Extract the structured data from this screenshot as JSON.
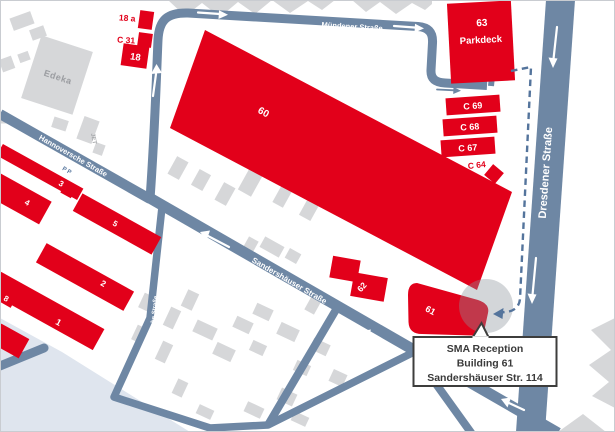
{
  "title": "SMA site map",
  "streets": {
    "muendener": "Mündener Straße",
    "dresdener": "Dresdener Straße",
    "hannoversche": "Hannoversche Straße",
    "sandershaeuser": "Sandershäuser Straße",
    "hallesche": "Hallesche Straße"
  },
  "buildings": {
    "b18a": "18 a",
    "c31": "C 31",
    "b18": "18",
    "b60": "60",
    "b63": "63",
    "b63_label": "Parkdeck",
    "c69": "C 69",
    "c68": "C 68",
    "c67": "C 67",
    "c64": "C 64",
    "b62": "62",
    "b61": "61",
    "b1": "1",
    "b2": "2",
    "b3": "3",
    "b4": "4",
    "b5": "5",
    "b8": "8",
    "edeka": "Edeka",
    "jet": "JET",
    "parking": "P P"
  },
  "callout": {
    "line1": "SMA Reception",
    "line2": "Building 61",
    "line3": "Sandershäuser Str. 114"
  },
  "colors": {
    "building_red": "#e2001a",
    "street_blue": "#6e87a4",
    "route_dash_blue": "#54749c",
    "gray_building": "#d6d7d9",
    "pale_area": "#dfe5ee",
    "callout_border": "#3d3d3c",
    "callout_text": "#3a3a3a"
  }
}
